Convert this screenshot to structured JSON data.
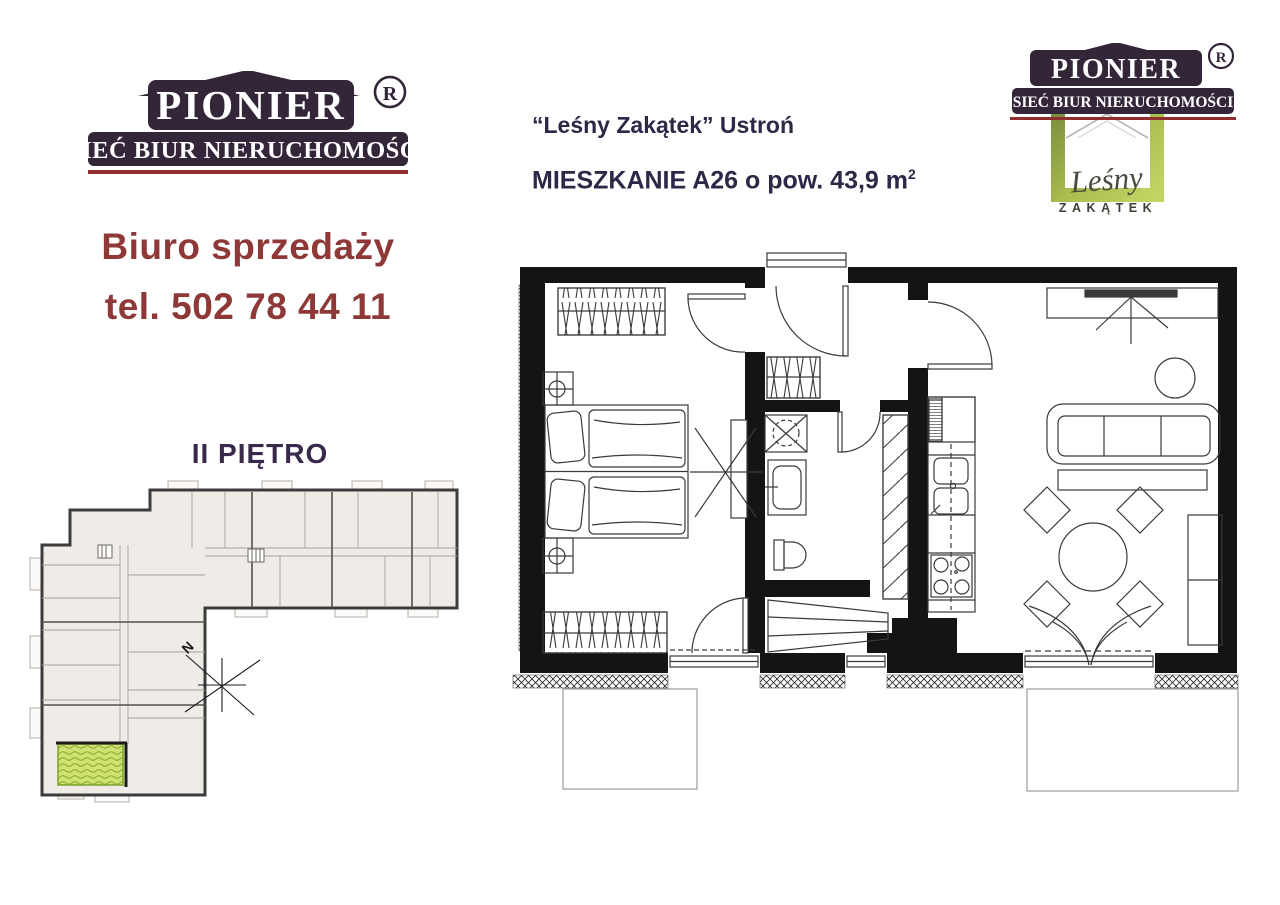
{
  "brand": {
    "name": "PIONIER",
    "registered": "®",
    "network": "SIEĆ BIUR NIERUCHOMOŚCI",
    "accent_dark": "#342639",
    "accent_red": "#8f2f2f"
  },
  "sales": {
    "line1": "Biuro sprzedaży",
    "phone": "tel. 502 78 44 11",
    "color": "#8e3838"
  },
  "floor_plan": {
    "label": "II PIĘTRO"
  },
  "listing": {
    "project": "“Leśny Zakątek” Ustroń",
    "title": "MIESZKANIE A26 o pow. 43,9 m",
    "area_sup": "2"
  },
  "estate_logo": {
    "script": "Leśny",
    "caps": "ZAKĄTEK",
    "green_dark": "#75873a",
    "green_light": "#c3d464",
    "highlight_fill": "#cfe170"
  },
  "compass": {
    "north": "N"
  }
}
